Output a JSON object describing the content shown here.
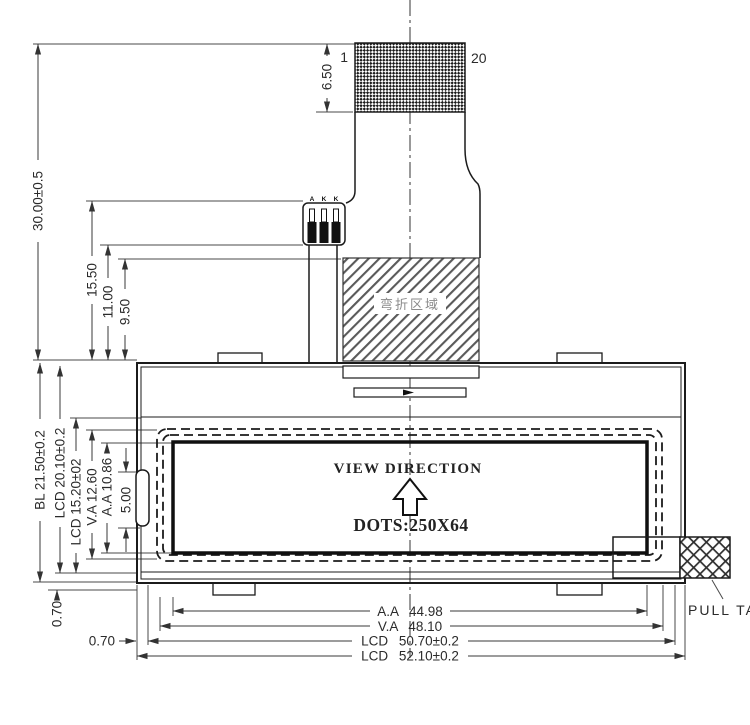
{
  "connector": {
    "pin_first": "1",
    "pin_last": "20",
    "pin_labels": [
      "A",
      "K",
      "K"
    ]
  },
  "fold_area_label": "弯折区域",
  "display_area": {
    "view_direction_label": "VIEW DIRECTION",
    "dots_label": "DOTS:250X64"
  },
  "pull_tab_label": "PULL TAB",
  "dimensions": {
    "overall_height": "30.00±0.5",
    "connector_height": "6.50",
    "fpc_step_1": "15.50",
    "fpc_step_2": "11.00",
    "fpc_step_3": "9.50",
    "bl_height": "BL 21.50±0.2",
    "lcd_height": "LCD 20.10±0.2",
    "lcd_inner_height": "LCD 15.20±02",
    "va_height": "V.A 12.60",
    "aa_height": "A.A 10.86",
    "notch_height": "5.00",
    "edge_offset_left": "0.70",
    "edge_offset_bottom": "0.70",
    "aa_width": "A.A 44.98",
    "va_width": "V.A 48.10",
    "lcd_width": "LCD 50.70±0.2",
    "module_width": "LCD 52.10±0.2"
  },
  "colors": {
    "line_dark": "#1b1b1b",
    "dim_line": "#3a3a3a",
    "hatch_gray": "#5a5a5a",
    "background": "#ffffff"
  }
}
